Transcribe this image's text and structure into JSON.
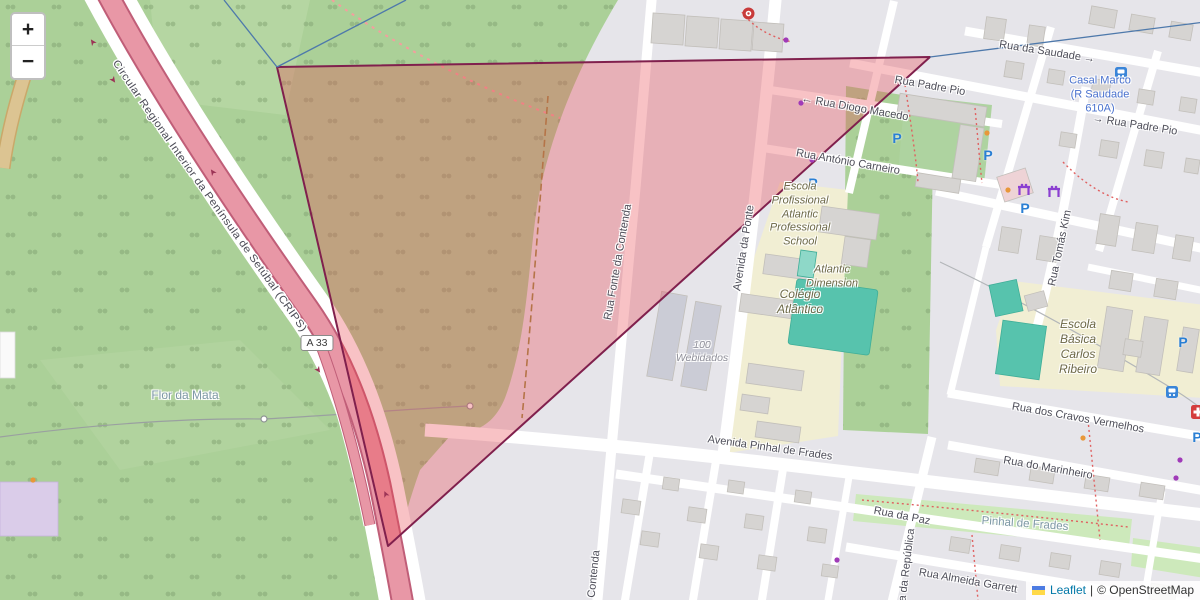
{
  "controls": {
    "zoom_in": "+",
    "zoom_out": "−"
  },
  "attribution": {
    "flag": "ukraine-flag-icon",
    "leaflet": "Leaflet",
    "separator": "|",
    "copyright": "© OpenStreetMap"
  },
  "road_shield": "A 33",
  "labels": {
    "rua_da_saudade": "Rua da Saudade →",
    "casal_marco": "Casal Marco\n(R Saudade\n610A)",
    "rua_padre_pio_top": "Rua Padre Pio",
    "rua_padre_pio_right": "→ Rua Padre Pio",
    "rua_diogo_macedo": "← Rua Diogo Macedo",
    "rua_antonio_carneiro": "Rua António Carneiro",
    "escola_profissional": "Escola\nProfissional\nAtlantic\nProfessional\nSchool",
    "atlantic_dimension": "Atlantic\nDimension",
    "colegio_atlantico": "Colégio\nAtlântico",
    "escola_basica": "Escola\nBásica\nCarlos\nRibeiro",
    "webidados": "100\nWebidados",
    "avenida_da_ponte": "Avenida da Ponte",
    "rua_fonte_da_contenda": "Rua Fonte da Contenda",
    "contenda_bottom": "Contenda",
    "rua_tomas_kim": "Rua Tomás Kim",
    "rua_dos_cravos_vermelhos": "Rua dos Cravos Vermelhos",
    "rua_do_marinheiro": "Rua do Marinheiro",
    "avenida_pinhal_de_frades": "Avenida Pinhal de Frades",
    "rua_da_paz": "Rua da Paz",
    "pinhal_de_frades": "Pinhal de Frades",
    "rua_almeida_garrett": "Rua Almeida Garrett",
    "rua_da_republica": "Rua da República",
    "crips": "Circular Regional Interior da Península de Setúbal (CRIPS)",
    "flor_da_mata": "Flor da Mata",
    "parking": "P"
  },
  "colors": {
    "forest": "#abd098",
    "motorway": "#e897a6",
    "motorway_casing": "#c05e78",
    "selection_fill": "rgba(235,70,80,0.33)",
    "selection_stroke": "#80204d",
    "school_area": "#f1eed3",
    "pitch": "#57c3ad",
    "boundary_blue": "#4e79ab"
  },
  "icons": {
    "bus_stop": "bus-icon",
    "clinic": "red-cross-icon",
    "fitness": "fitness-icon",
    "poi_red": "red-circle-icon",
    "parking": "parking-icon"
  }
}
